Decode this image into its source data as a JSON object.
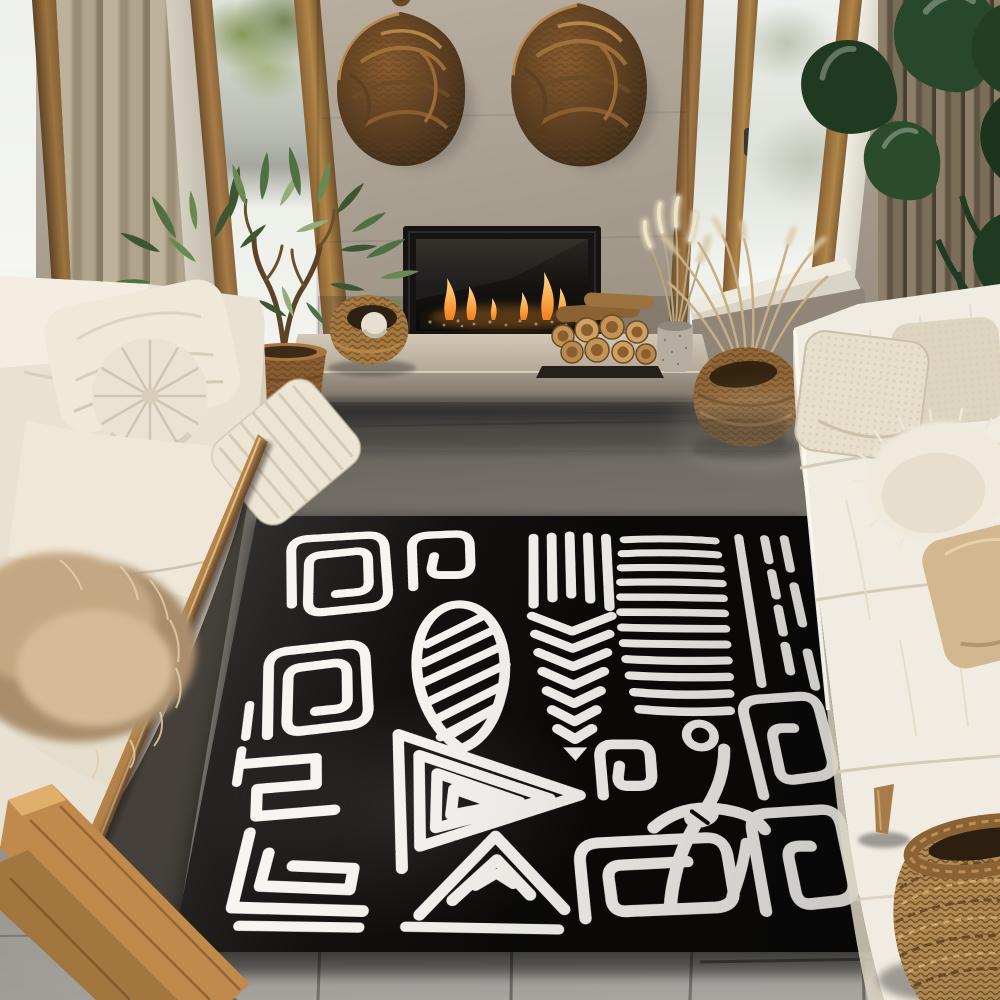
{
  "scene": {
    "label": "Sunlit living room with two cream sofas facing a large black and white mola-style area rug in front of a concrete fireplace wall",
    "style": "photograph"
  },
  "palette": {
    "rug-black": "#0b0a09",
    "rug-white": "#f6f4ef",
    "wall": "#a89e90",
    "wood-frame": "#9c7544",
    "sofa-cream": "#ece5d6",
    "floor-gray": "#8f8c86",
    "floor-dark": "#55514a",
    "curtain-left": "#b3a78f",
    "curtain-right": "#7b6e59",
    "plant-green": "#2e4a2b",
    "tree-green": "#4e6a40",
    "wicker": "#8a5f33",
    "flame-orange": "#f49336",
    "fur-tan": "#b69b7a",
    "hearth-stone": "#c6bcab"
  },
  "objects": {
    "rug": {
      "label": "Black and white abstract mola pattern area rug",
      "motifs": [
        "square spiral",
        "hook spiral",
        "striped leaf",
        "chevron fern",
        "comb stripes",
        "border dashes",
        "maze meander",
        "triangle spiral",
        "ring dot",
        "anchor figure",
        "nested square spirals"
      ]
    },
    "fireplace": {
      "label": "Linear gas fireplace with black frame and orange flames"
    },
    "hearth": {
      "label": "Concrete hearth bench"
    },
    "wall-baskets": {
      "label": "Two round woven wall baskets hanging above the fireplace"
    },
    "left-sofa": {
      "label": "Cream sofa with pillows and a tan fur throw on a wood base"
    },
    "right-sofa": {
      "label": "White sofa with boucle and fluffy pillows"
    },
    "potted-tree": {
      "label": "Potted tree in a wicker basket planter by the left window"
    },
    "monstera": {
      "label": "Dark green glossy foliage plant at the top right"
    },
    "firewood": {
      "label": "Stacked firewood beside the fireplace"
    },
    "pampas": {
      "label": "Pampas grass in a stone vase on the hearth"
    },
    "grass-basket": {
      "label": "Wicker basket with dried grasses below the right window"
    },
    "floor-basket": {
      "label": "Large woven basket on the floor at bottom right"
    },
    "windows": {
      "label": "Tall oak framed windows with bright daylight"
    },
    "curtains": {
      "label": "Beige and taupe floor length curtains"
    },
    "floor": {
      "label": "Large gray tile floor"
    }
  }
}
